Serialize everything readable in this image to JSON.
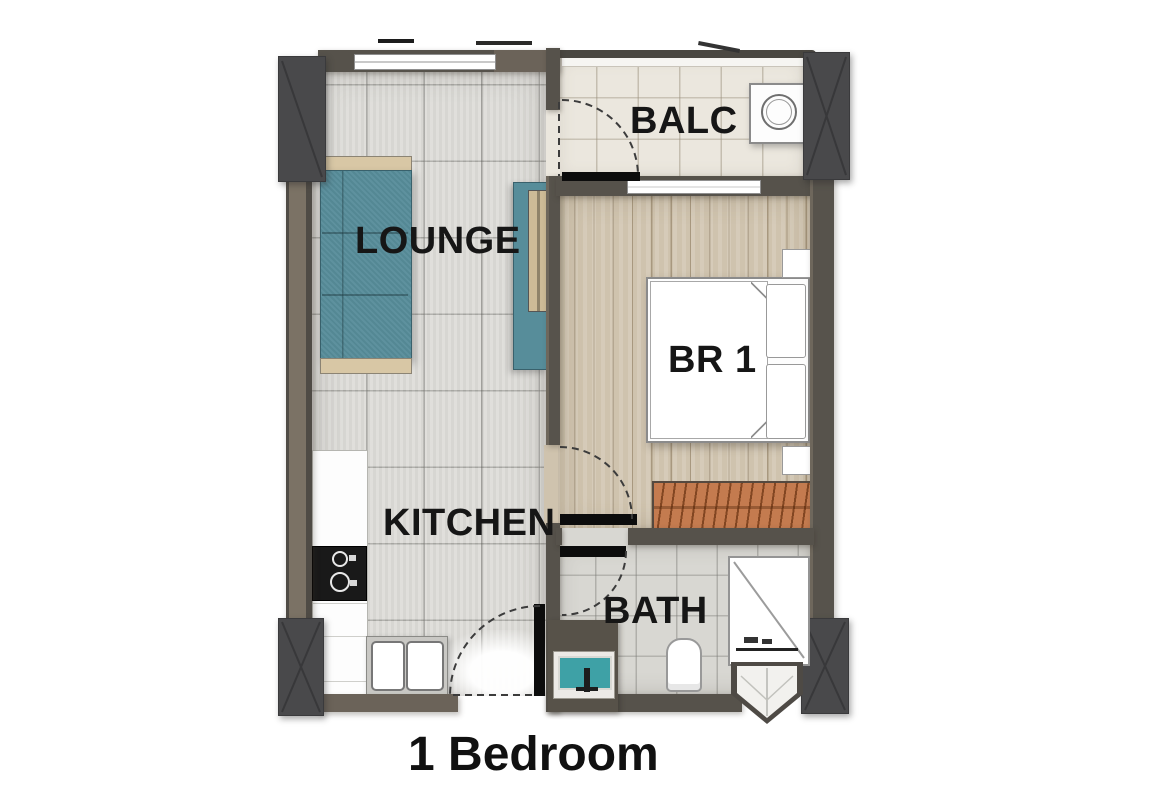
{
  "title": "1 Bedroom",
  "rooms": {
    "lounge": "LOUNGE",
    "balcony": "BALC",
    "bedroom": "BR 1",
    "kitchen": "KITCHEN",
    "bath": "BATH"
  },
  "colors": {
    "wall": "#56524b",
    "column": "#49494b",
    "sofa_teal": "#578d9a",
    "tv_console_teal": "#578d9a",
    "wardrobe_orange": "#bf7040",
    "vanity_basin_teal": "#3ea1a6",
    "door_leaf": "#0c0c0c",
    "lounge_floor": "#dcdbd7",
    "balcony_floor": "#ebe7de",
    "bedroom_floor": "#cfc3ae",
    "bath_floor": "#d8d7d2",
    "label_text": "#161616"
  }
}
